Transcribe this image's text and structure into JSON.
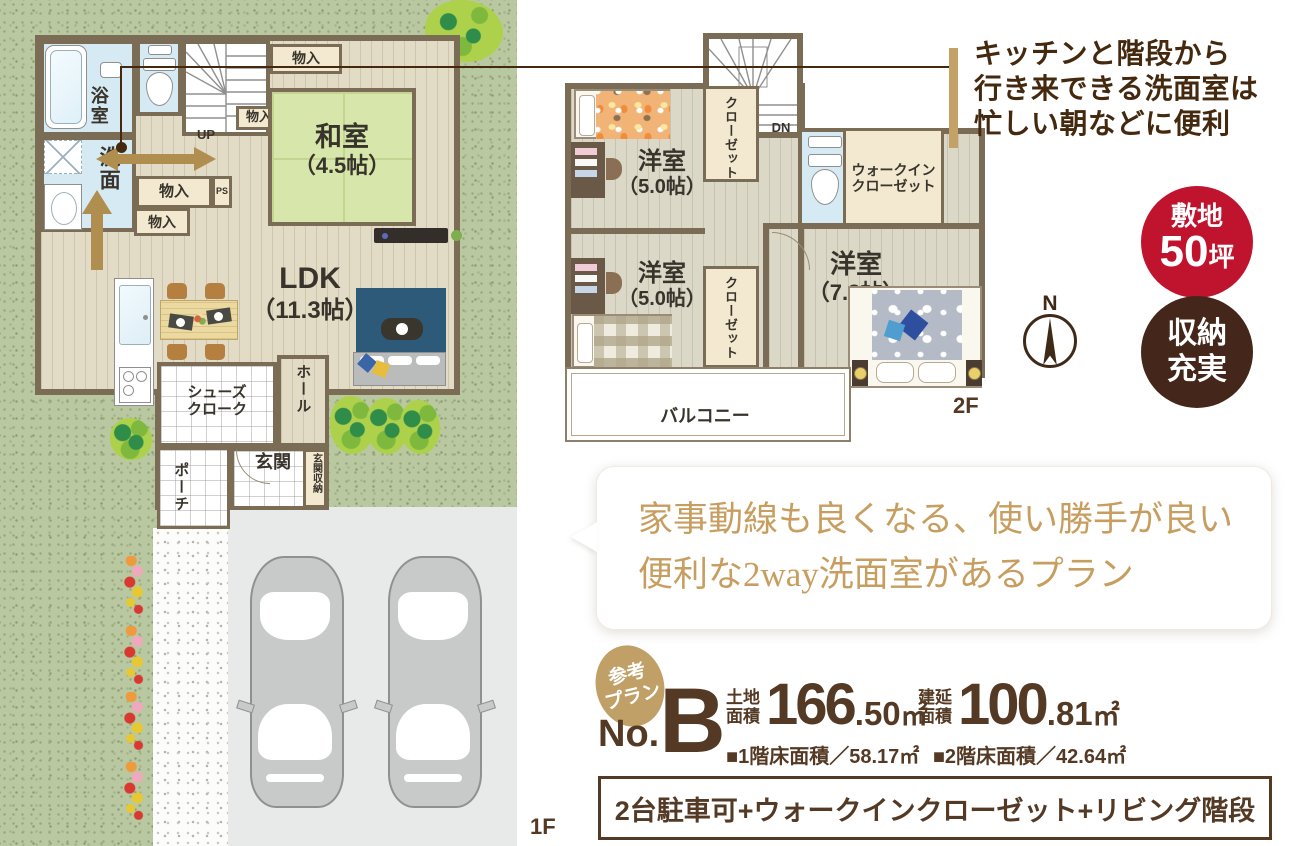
{
  "annotation": {
    "lines": [
      "キッチンと階段から",
      "行き来できる洗面室は",
      "忙しい朝などに便利"
    ],
    "bar_color": "#c2a267",
    "text_color": "#44290f"
  },
  "badges": {
    "site": {
      "label": "敷地",
      "value": "50",
      "unit": "坪",
      "bg": "#c0142e"
    },
    "storage": {
      "line1": "収納",
      "line2": "充実",
      "bg": "#44271a"
    }
  },
  "bubble": {
    "line1": "家事動線も良くなる、使い勝手が良い",
    "line2": "便利な2way洗面室があるプラン",
    "text_color": "#c79e5f"
  },
  "plan_info": {
    "ref_line1": "参考",
    "ref_line2": "プラン",
    "no_prefix": "No.",
    "no_letter": "B",
    "land_label1": "土地",
    "land_label2": "面積",
    "land_int": "166",
    "land_dec": ".50",
    "land_unit": "㎡",
    "bld_label1": "建延",
    "bld_label2": "面積",
    "bld_int": "100",
    "bld_dec": ".81",
    "bld_unit": "㎡",
    "floor_area_1": "■1階床面積／58.17㎡",
    "floor_area_2": "■2階床面積／42.64㎡",
    "features": "2台駐車可+ウォークインクローゼット+リビング階段",
    "accent": "#543a24"
  },
  "floor1": {
    "floor_label": "1F",
    "bath": "浴室",
    "wash": "洗面",
    "stairs_up": "UP",
    "storage": "物入",
    "ps": "PS",
    "washitsu_name": "和室",
    "washitsu_size": "（4.5帖）",
    "ldk_name": "LDK",
    "ldk_size": "（11.3帖）",
    "shoes_line1": "シューズ",
    "shoes_line2": "クローク",
    "hall": "ホール",
    "genkan": "玄関",
    "genkan_storage": "玄関収納",
    "porch": "ポーチ"
  },
  "floor2": {
    "floor_label": "2F",
    "stairs_down": "DN",
    "closet": "クローゼット",
    "wic_line1": "ウォークイン",
    "wic_line2": "クローゼット",
    "room_a_name": "洋室",
    "room_a_size": "（5.0帖）",
    "room_b_name": "洋室",
    "room_b_size": "（5.0帖）",
    "room_c_name": "洋室",
    "room_c_size": "（7.8帖）",
    "balcony": "バルコニー"
  },
  "compass": {
    "north": "N"
  }
}
